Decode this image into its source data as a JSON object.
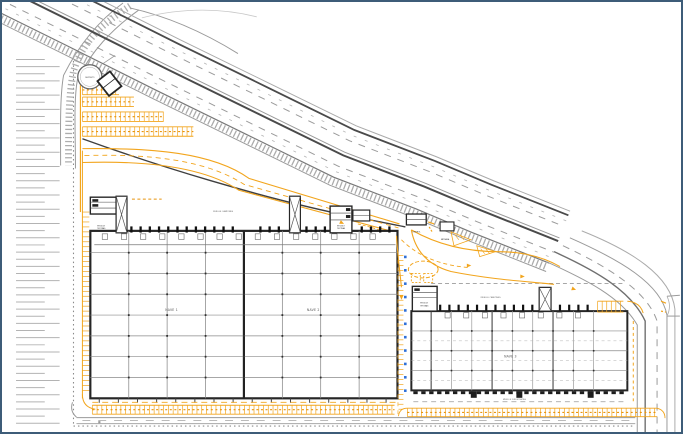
{
  "drawing": {
    "type": "logistics-park-site-plan",
    "labels": {
      "nave1": "NAVE 1",
      "nave2": "NAVE 2",
      "nave3": "NAVE 3",
      "muelle_camiones_left": "MUELLE CAMIONES",
      "muelle_camiones_right": "MUELLE CAMIONES",
      "muelle_furgonetas": "MUELLE FURGONETAS",
      "modulo_line1": "MODULO",
      "modulo_line2": "OFICINAS",
      "deposito": "DEPOSITO",
      "control": "CONTROL",
      "entrada": "ENTRADA"
    },
    "colors": {
      "paper": "#FFFFFF",
      "frame_border": "#3D5C78",
      "line_light": "#B3B3B3",
      "line_mid": "#8C8C8C",
      "line_dark": "#3F3F3F",
      "building_line": "#262626",
      "accent_yellow": "#F2A51D",
      "accent_orange": "#E8930C",
      "blue_marker": "#2E6FD8"
    }
  }
}
